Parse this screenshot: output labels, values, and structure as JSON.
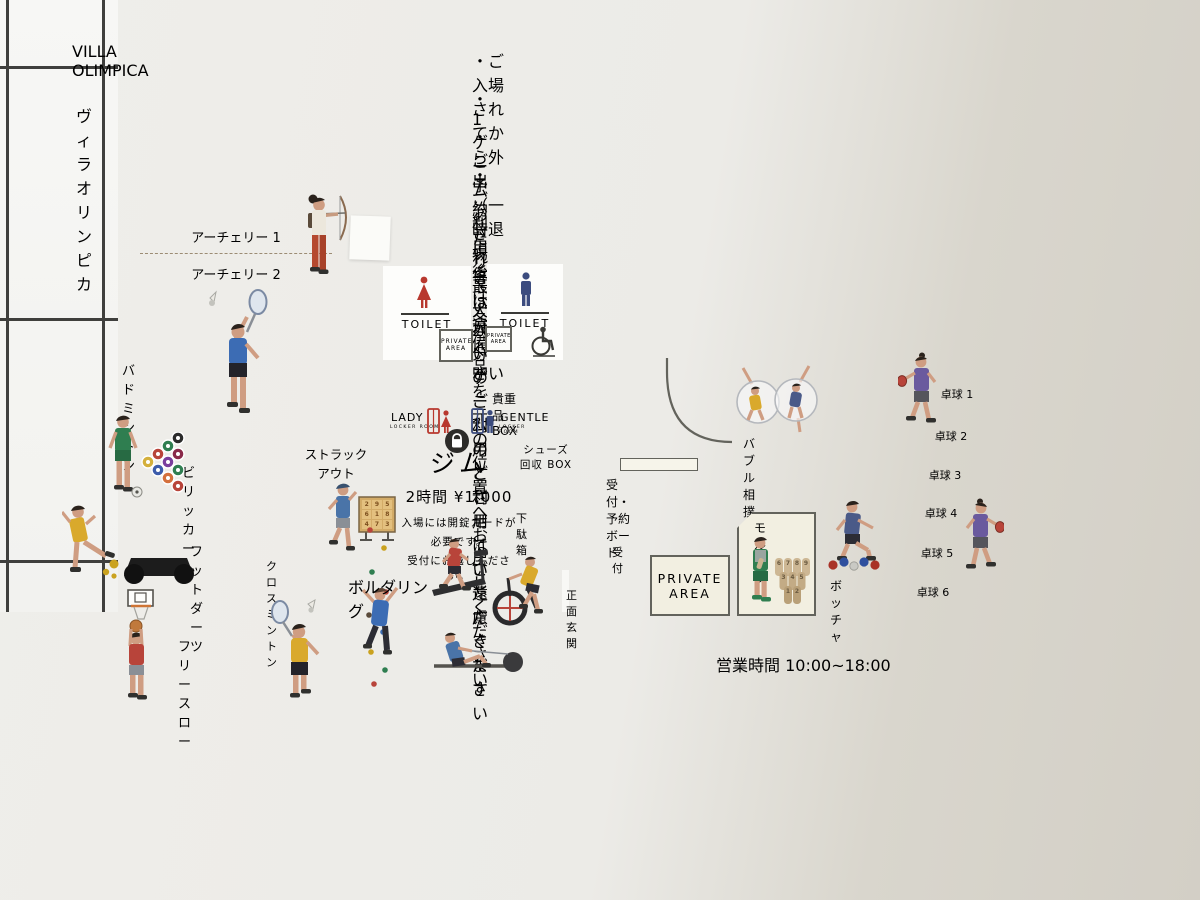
{
  "poster": {
    "title": "VILLA OLIMPICA",
    "title_kana": "ヴィラオリンピカ",
    "rules": [
      "・ご入場されてから外出（一時退場等）はご遠慮ください",
      "・1ゲームあたり最大 20 分のご利用とさせていただきます",
      "・ご予約されていないゲームのご利用はご遠慮ください",
      "・ご利用後は各備品を元の位置へお戻しください"
    ],
    "hours": "営業時間 10:00~18:00"
  },
  "map": {
    "labels": {
      "archery_1": "アーチェリー 1",
      "archery_2": "アーチェリー 2",
      "badminton": "バドミントン",
      "billicker": "ビリッカー",
      "foot_darts": "フットダーツ",
      "free_throw": "フリースロー",
      "crossminton": "クロスミントン",
      "strike_out": [
        "ストラック",
        "アウト"
      ],
      "bouldering": "ボルダリング",
      "valuables_box": "貴重品BOX",
      "lady": "LADY",
      "gentle": "GENTLE",
      "locker_room": "LOCKER ROOM",
      "gym": "ジム",
      "gym_price": "2時間 ¥1,000",
      "gym_notes": [
        "入場には開錠カードが",
        "必要です。",
        "受付にお越しください。"
      ],
      "toilet": "TOILET",
      "private": "PRIVATE",
      "area": "AREA",
      "shoes_box": [
        "シューズ",
        "回収 BOX"
      ],
      "shoe_rack": "下駄箱",
      "reception_board": "受付・予約ボード",
      "reception": "受付",
      "main_entrance": "正面玄関",
      "bubble_sumo": "バブル相撲",
      "molkky": "モルック",
      "boccia": "ボッチャ",
      "table_tennis": [
        "卓球 1",
        "卓球 2",
        "卓球 3",
        "卓球 4",
        "卓球 5",
        "卓球 6"
      ]
    },
    "strike_out_numbers": [
      "2",
      "9",
      "5",
      "6",
      "1",
      "8",
      "4",
      "7",
      "3"
    ],
    "molkky_numbers": [
      "6",
      "7",
      "8",
      "9",
      "3",
      "4",
      "5",
      "1",
      "2"
    ],
    "colors": {
      "room_fill": "#f2efe1",
      "gym_fill": "#aeb6b0",
      "wall": "#63635c",
      "zone_dash": "#9c8c74",
      "zone_dash_red": "#a2593b",
      "lady_red": "#b8382e",
      "gentle_blue": "#3c4c7e"
    }
  }
}
